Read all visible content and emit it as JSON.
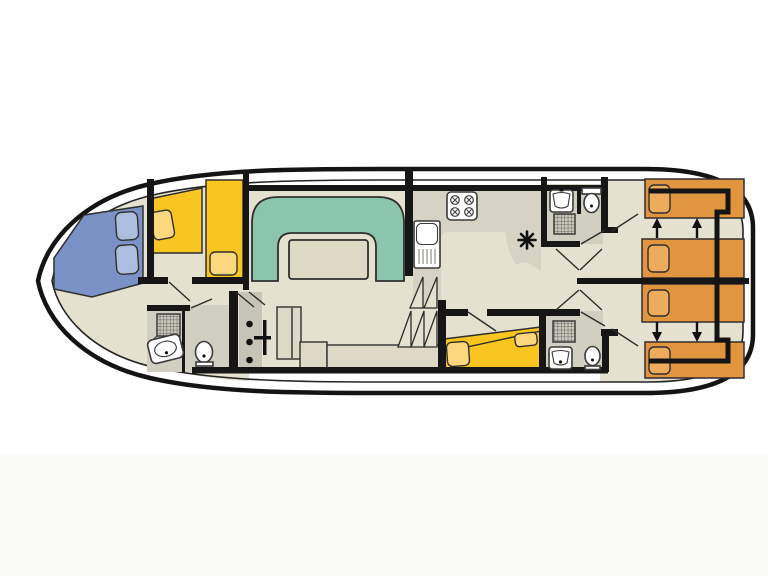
{
  "title": "Canal boat deck floor plan",
  "colors": {
    "hull_line": "#141414",
    "floor": "#e5e1d0",
    "bath_floor": "#d1cfc1",
    "counter": "#d6d3c4",
    "entry_strip": "#c6c3b7",
    "furniture": "#ddd9c6",
    "sofa_teal": "#8cc5ae",
    "table_top": "#ddd9c5",
    "bed_blue": "#7b92c6",
    "pillow_blue": "#abbedf",
    "bed_yellow": "#f8c521",
    "pillow_yellow": "#fbd87d",
    "bed_orange": "#e2953f",
    "pillow_orange": "#edab5e",
    "shower_tray": "#c9c7b9",
    "fixture_white": "#ffffff"
  },
  "plan": {
    "rooms": [
      "bow-cabin",
      "bow-bathroom",
      "saloon",
      "galley",
      "guest-cabin",
      "aft-bathroom-top",
      "aft-bathroom-bottom",
      "stern-cabin-top",
      "stern-cabin-bottom"
    ],
    "furniture_counts": {
      "double_beds_blue": 1,
      "single_beds_yellow": 3,
      "single_beds_orange": 4,
      "dinette_sofas": 1,
      "tables": 1,
      "toilets": 3,
      "showers": 3,
      "washbasins": 3,
      "stoves": 1,
      "sinks": 1,
      "stairs": 1
    },
    "icons": [
      "shower-grid-icon",
      "toilet-icon",
      "washbasin-icon",
      "stove-burners-icon",
      "sink-drainer-icon",
      "heater-asterisk-icon",
      "bed-join-arrow-icon",
      "stairs-icon",
      "helm-icon"
    ]
  }
}
